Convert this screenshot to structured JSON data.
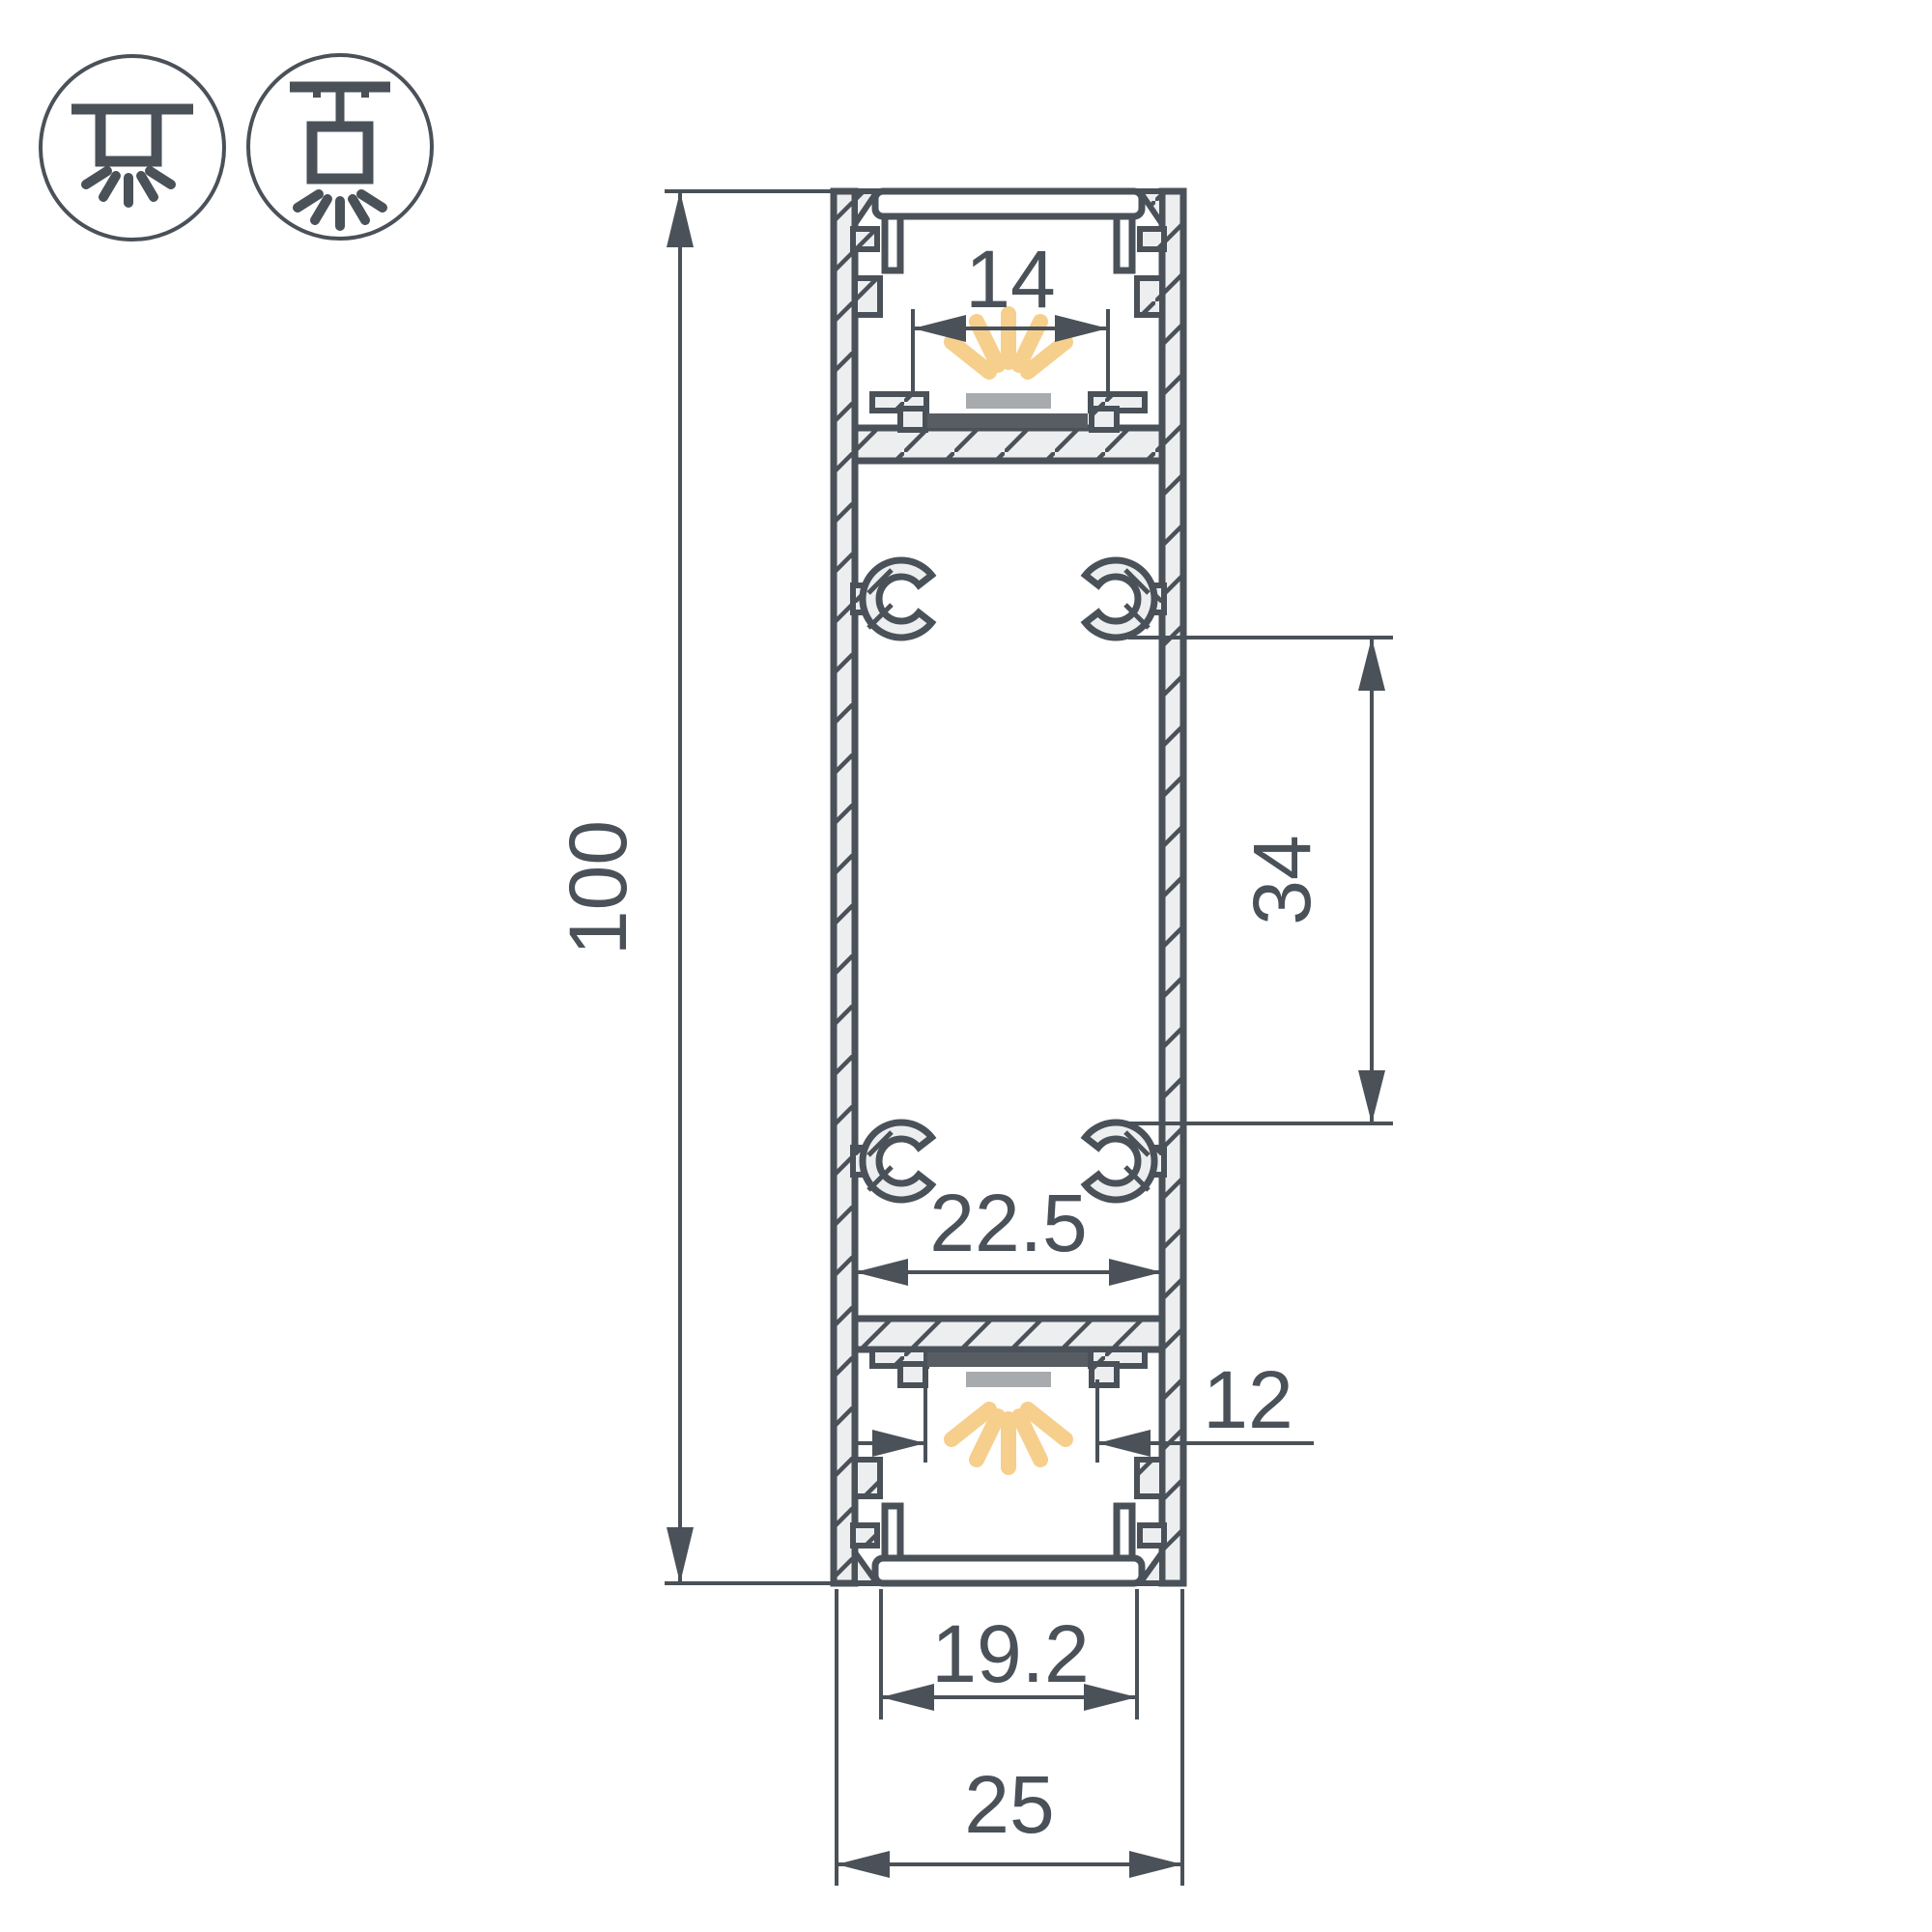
{
  "colors": {
    "line": "#4a5158",
    "wall_fill": "#eceef0",
    "ray": "#f6cf8d",
    "emitter": "#a8abae",
    "led_bar": "#575d63",
    "text": "#4a5158",
    "bg": "#ffffff"
  },
  "icons": {
    "surface_mount": "surface-mount-luminaire",
    "pendant_mount": "pendant-mount-luminaire"
  },
  "dims": {
    "overall_height": "100",
    "top_window": "14",
    "boss_spacing": "34",
    "inner_width": "22.5",
    "bottom_window": "12",
    "bottom_opening": "19.2",
    "overall_width": "25"
  }
}
